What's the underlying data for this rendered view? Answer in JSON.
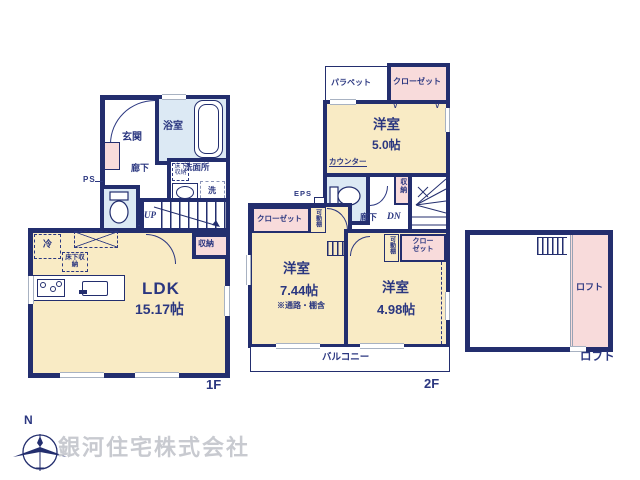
{
  "colors": {
    "wall": "#232e6e",
    "room_fill": "#f9ebc5",
    "closet_fill": "#f8dbdb",
    "wet_area_fill": "#dce9f4",
    "text": "#2b3780"
  },
  "compass": {
    "north_label": "N"
  },
  "company": {
    "name": "銀河住宅株式会社"
  },
  "floors": {
    "f1": {
      "floor_label": "1F",
      "ps": "PS",
      "entrance": "玄関",
      "bathroom": "浴室",
      "hallway": "廊下",
      "washroom": "洗面所",
      "washer": "洗",
      "underfloor_a": "床下収納",
      "stairs_up": "UP",
      "storage": "収納",
      "fridge": "冷",
      "underfloor_b": "床下収納",
      "ldk_name": "LDK",
      "ldk_size": "15.17帖"
    },
    "f2": {
      "floor_label": "2F",
      "parapet": "パラペット",
      "closet_a": "クローゼット",
      "room_a_name": "洋室",
      "room_a_size": "5.0帖",
      "fold_mark": "∨",
      "counter": "カウンター",
      "eps": "EPS",
      "hallway": "廊下",
      "stairs_down": "DN",
      "storage": "収納",
      "closet_b": "クローゼット",
      "shelf_a": "可動棚",
      "room_b_name": "洋室",
      "room_b_size": "7.44帖",
      "room_b_note": "※通路・棚含",
      "shelf_b": "可動棚",
      "closet_c": "クローゼット",
      "room_c_name": "洋室",
      "room_c_size": "4.98帖",
      "balcony": "バルコニー"
    },
    "loft": {
      "label_inside": "ロフト",
      "label_outside": "ロフト"
    }
  }
}
